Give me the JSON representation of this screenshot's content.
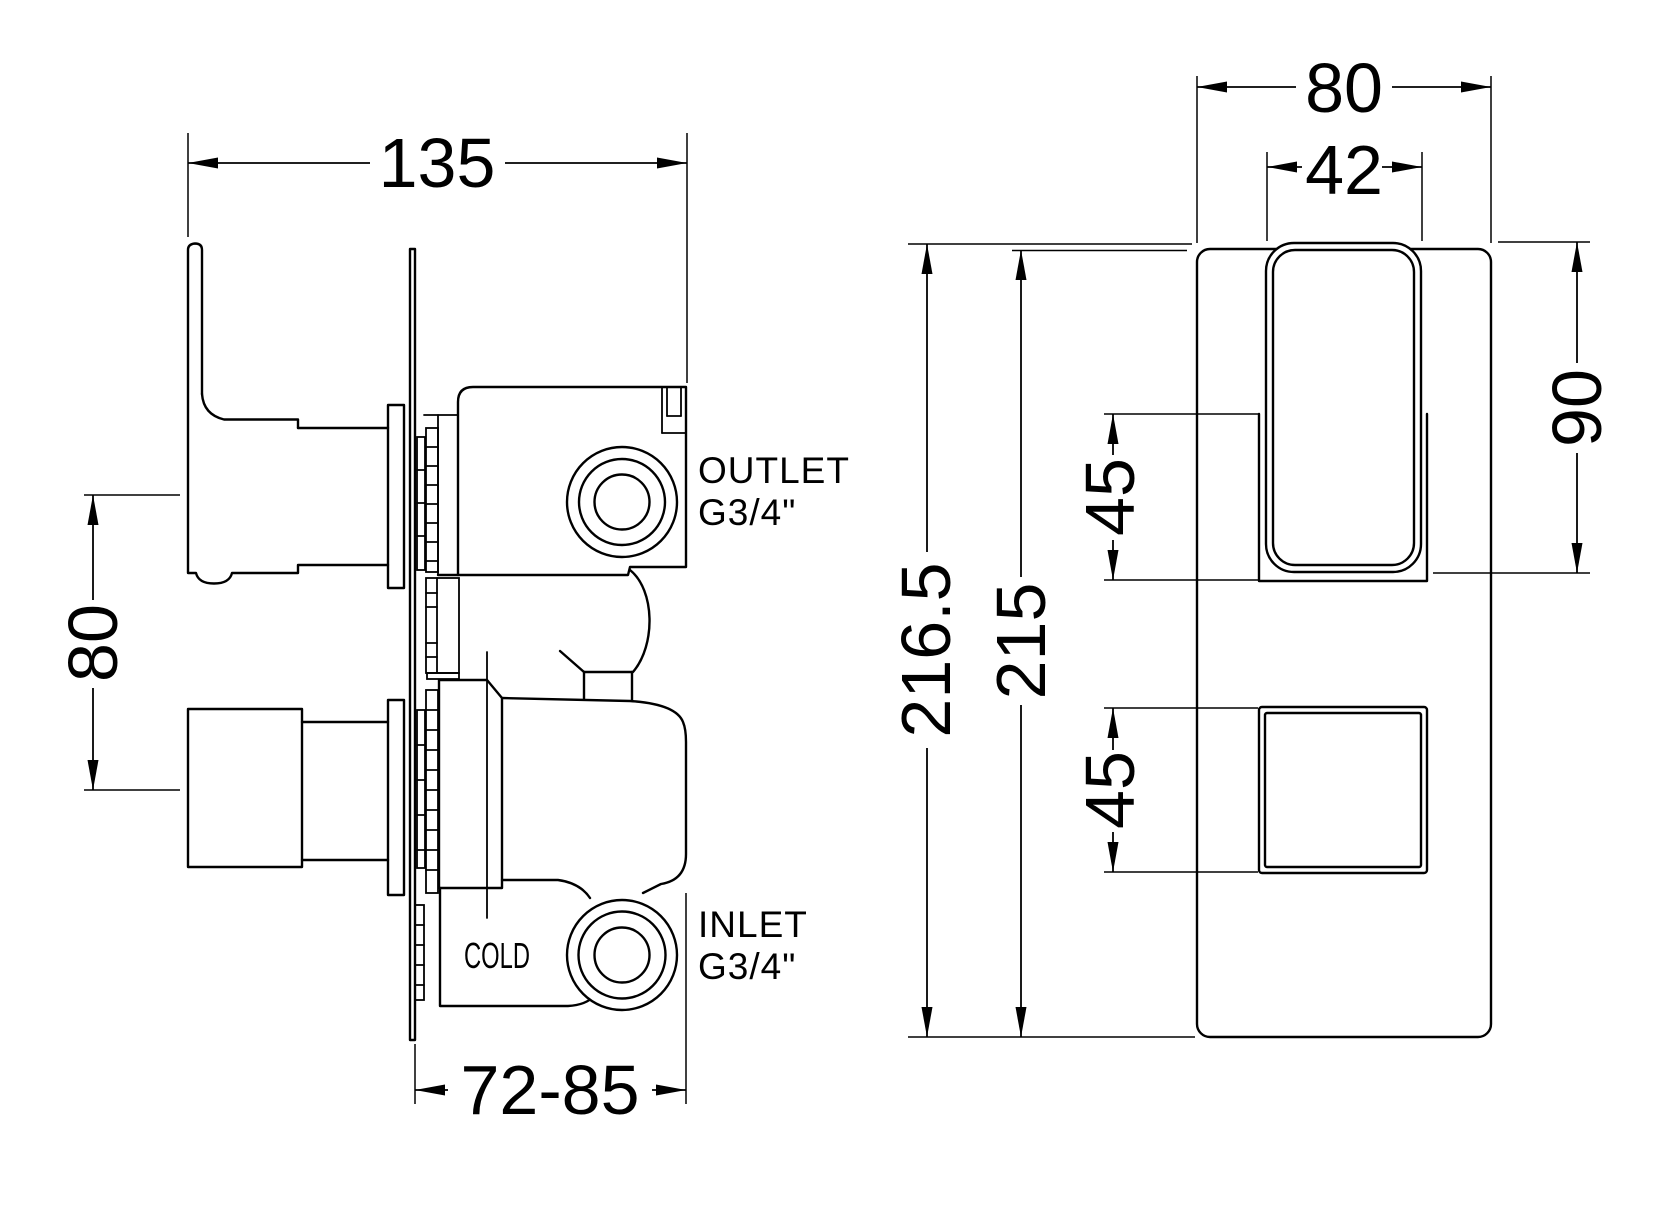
{
  "drawing": {
    "background_color": "#ffffff",
    "line_color": "#000000",
    "side_view": {
      "dim_width": "135",
      "dim_handle_spacing": "80",
      "dim_depth": "72-85",
      "label_outlet": "OUTLET",
      "label_outlet_size": "G3/4\"",
      "label_inlet": "INLET",
      "label_inlet_size": "G3/4\"",
      "label_cold": "COLD"
    },
    "front_view": {
      "dim_plate_width": "80",
      "dim_handle_width": "42",
      "dim_total_height": "216.5",
      "dim_plate_height": "215",
      "dim_handle_height": "90",
      "dim_upper_handle": "45",
      "dim_lower_handle": "45"
    }
  }
}
